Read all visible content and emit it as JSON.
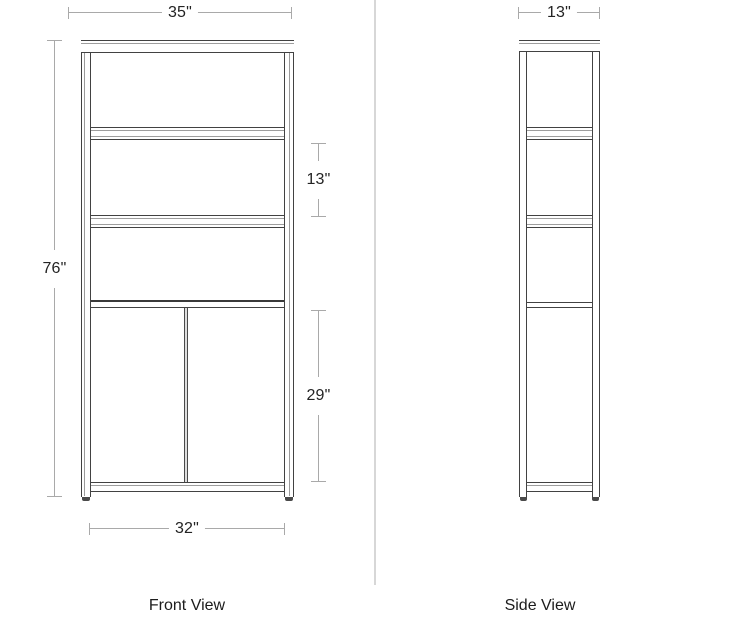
{
  "colors": {
    "ink": "#424242",
    "dim": "#a9a9a9",
    "txt": "#232323",
    "divider": "#d7d7d7"
  },
  "front_view": {
    "label": "Front View",
    "dimensions": {
      "width_top": "35\"",
      "height_left": "76\"",
      "shelf_spacing_right": "13\"",
      "door_height_right": "29\"",
      "base_width_bottom": "32\""
    }
  },
  "side_view": {
    "label": "Side View",
    "dimensions": {
      "depth_top": "13\""
    }
  }
}
